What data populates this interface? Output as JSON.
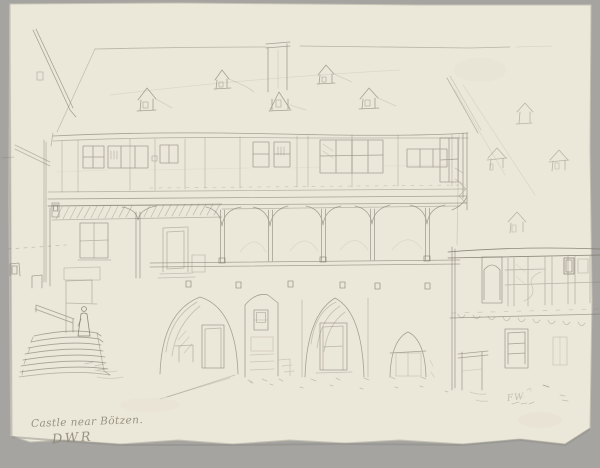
{
  "artwork": {
    "caption_line1": "Castle near Bötzen.",
    "caption_line2": "DWR",
    "corner_mark": "FW",
    "medium": "pencil sketch on cream paper",
    "subject": "Castle courtyard: half-timbered upper storey over a wooden gallery arcade, large dormered roof with chimney, outside staircase with figure at left, arched doorways below, half-timbered wing at right"
  },
  "palette": {
    "backdrop": "#a5a4a0",
    "paper": "#ebe7d9",
    "paper_edge_shadow": "#8b8a86",
    "pencil": "#7c7669",
    "pencil_dark": "#5a544a",
    "handwriting": "#8b8472"
  }
}
